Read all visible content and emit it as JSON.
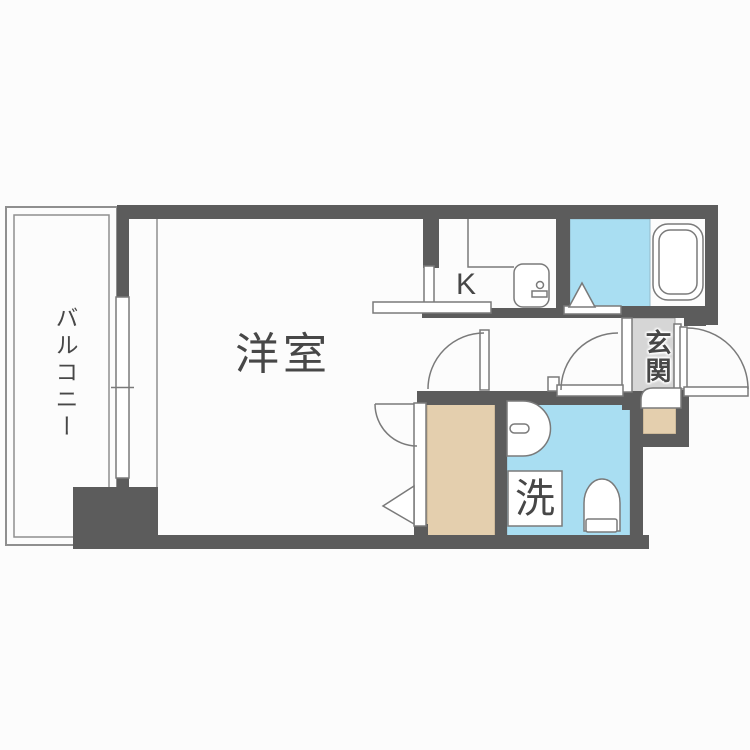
{
  "title": "1K apartment floor plan",
  "colors": {
    "wall": "#5c5c5c",
    "outline": "#7a7a7a",
    "water_blue": "#a9def2",
    "wood_tan": "#e4cfae",
    "entry_gray": "#d6d6d6",
    "label_text": "#474747",
    "background": "#fcfcfc"
  },
  "rooms": {
    "living": {
      "label": "洋室"
    },
    "balcony": {
      "label": "バルコニー"
    },
    "kitchen": {
      "label": "K"
    },
    "entrance": {
      "label": "玄関"
    },
    "laundry": {
      "label": "洗"
    }
  }
}
